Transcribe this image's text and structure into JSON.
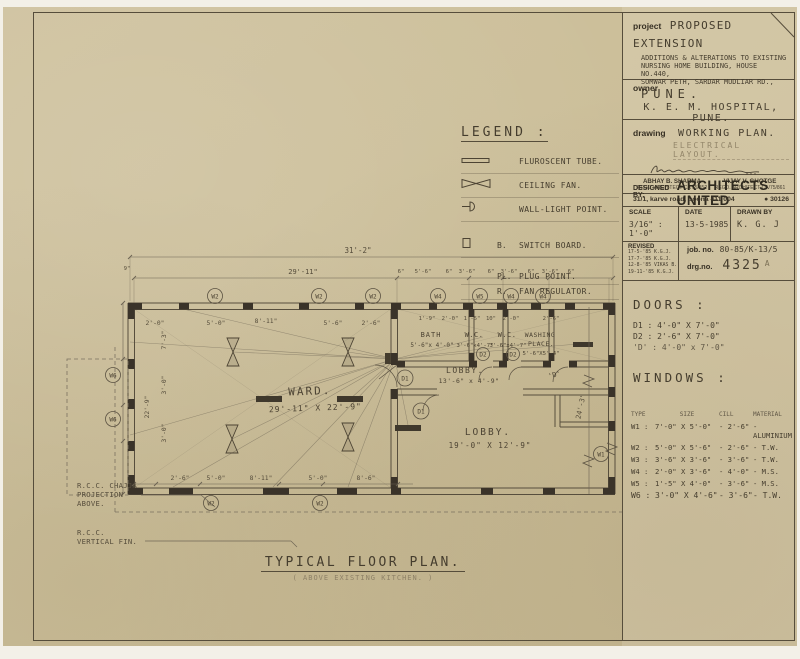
{
  "sheet": {
    "footer_title": "TYPICAL FLOOR PLAN.",
    "footer_subtitle": "( ABOVE EXISTING KITCHEN. )"
  },
  "title_block": {
    "project": {
      "label": "project",
      "title": "PROPOSED EXTENSION",
      "line1": "ADDITIONS & ALTERATIONS TO EXISTING",
      "line2": "NURSING HOME BUILDING, HOUSE NO.440,",
      "line3": "SOMWAR PETH, SARDAR MUDLIAR RD.,",
      "city": "PUNE."
    },
    "owner": {
      "label": "owner",
      "name": "K. E. M. HOSPITAL, PUNE."
    },
    "drawing": {
      "label": "drawing",
      "title": "WORKING PLAN.",
      "stamp": "ELECTRICAL LAYOUT.",
      "architect1_name": "ABHAY B. SHARMA",
      "architect1_reg": "REGD. ARCHITECT CA 75/852",
      "architect2_name": "VIJAY V. GHOTGE",
      "architect2_reg": "REGD. ARCHITECT CA/75/861"
    },
    "designed_by": {
      "label": "DESIGNED BY:",
      "firm": "ARCHITECTS UNITED",
      "address": "31/1, karve road, poona 411 004",
      "phone": "30126"
    },
    "meta": {
      "scale_label": "SCALE",
      "scale_value": "3/16\" : 1'-0\"",
      "date_label": "DATE",
      "date_value": "13-5-1985",
      "drawn_label": "DRAWN BY",
      "drawn_value": "K. G. J"
    },
    "revision": {
      "label": "REVISED",
      "entries": [
        "17-5-'85 K.G.J.",
        "17-7-'85 K.G.J.",
        "12-8-'85 VIKAS B.",
        "19-11-'85 K.G.J."
      ],
      "job_label": "job. no.",
      "job_value": "80-85/K-13/5",
      "drg_label": "drg.no.",
      "drg_value": "4325",
      "drg_suffix": "A"
    },
    "doors": {
      "title": "DOORS :",
      "items": [
        "D1 : 4'-0\" X 7'-0\"",
        "D2 : 2'-6\" X 7'-0\"",
        "'D' : 4'-0\" x 7'-0\""
      ]
    },
    "windows": {
      "title": "WINDOWS :",
      "headers": [
        "TYPE",
        "SIZE",
        "CILL",
        "MATERIAL"
      ],
      "rows": [
        {
          "type": "W1 :",
          "size": "7'-0\" X 5'-0\"",
          "cill": "- 2'-6\"",
          "material": "- ALUMINIUM"
        },
        {
          "type": "W2 :",
          "size": "5'-0\" X 5'-6\"",
          "cill": "- 2'-6\"",
          "material": "- T.W."
        },
        {
          "type": "W3 :",
          "size": "3'-6\" X 3'-6\"",
          "cill": "- 3'-6\"",
          "material": "- T.W."
        },
        {
          "type": "W4 :",
          "size": "2'-0\" X 3'-6\"",
          "cill": "- 4'-0\"",
          "material": "- M.S."
        },
        {
          "type": "W5 :",
          "size": "1'-5\" X 4'-0\"",
          "cill": "- 3'-6\"",
          "material": "- M.S."
        },
        {
          "type": "W6 :",
          "size": "3'-0\" X 4'-6\"",
          "cill": "- 3'-6\"",
          "material": "- T.W."
        }
      ]
    }
  },
  "legend": {
    "title": "LEGEND :",
    "items": [
      {
        "icon": "fluorescent-tube",
        "prefix": "",
        "label": "FLUROSCENT TUBE."
      },
      {
        "icon": "ceiling-fan",
        "prefix": "",
        "label": "CEILING FAN."
      },
      {
        "icon": "wall-light",
        "prefix": "",
        "label": "WALL-LIGHT POINT."
      },
      {
        "icon": "switch-board",
        "prefix": "B.",
        "label": "SWITCH BOARD."
      },
      {
        "icon": "none",
        "prefix": "PL.",
        "label": "PLUG POINT."
      },
      {
        "icon": "none",
        "prefix": "R.",
        "label": "FAN REGULATOR."
      }
    ]
  },
  "plan": {
    "rooms": {
      "ward_name": "WARD.",
      "ward_size": "29'-11\" X 22'-9\"",
      "bath_name": "BATH",
      "bath_size": "5'-6\"x 4'-0\"",
      "wc1_name": "W.C.",
      "wc1_size": "3'-6\"x4'-7\"",
      "wc2_name": "W.C.",
      "wc2_size": "3'-6\"x4'-7\"",
      "wash_name1": "WASHING",
      "wash_name2": "PLACE.",
      "wash_size": "5'-6\"X5'-4\"",
      "lobby1_name": "LOBBY.",
      "lobby1_size": "13'-6\" x 4'-9\"",
      "lobby2_name": "LOBBY.",
      "lobby2_size": "19'-0\" X 12'-9\""
    },
    "dims": {
      "overall": "31'-2\"",
      "ward_width": "29'-11\"",
      "left_offset": "9\"",
      "top_small": [
        "6\"",
        "5'-6\"",
        "6\"",
        "3'-6\"",
        "6\"",
        "3'-6\"",
        "6\"",
        "3'-6\"",
        "6\""
      ],
      "inner_top": [
        "2'-0\"",
        "5'-0\"",
        "8'-11\"",
        "5'-6\"",
        "2'-6\""
      ],
      "bath_row": [
        "1'-9\"",
        "2'-0\"",
        "1'-5\"",
        "10\"",
        "2'-0\"",
        "2'-6\""
      ],
      "bottom_row": [
        "2'-6\"",
        "5'-0\"",
        "8'-11\"",
        "5'-0\"",
        "8'-6\""
      ],
      "left_vertical": [
        "7'-3\"",
        "3'-0\"",
        "22'-9\"",
        "3'-0\""
      ],
      "right_vertical": "24'-3\""
    },
    "window_tags": {
      "top": [
        "W2",
        "W2",
        "W2",
        "W4",
        "W5",
        "W4",
        "W4"
      ],
      "left": [
        "W6",
        "W6"
      ],
      "bottom": [
        "W2",
        "W2"
      ],
      "right": [
        "W1"
      ]
    },
    "door_tags": {
      "d1a": "D1",
      "d1b": "D1",
      "d2a": "D2",
      "d2b": "D2",
      "d_quoted": "'D'"
    },
    "notes": {
      "chajja_line1": "R.C.C. CHAJJA",
      "chajja_line2": "PROJECTION",
      "chajja_line3": "ABOVE.",
      "fin_line1": "R.C.C.",
      "fin_line2": "VERTICAL FIN."
    }
  }
}
